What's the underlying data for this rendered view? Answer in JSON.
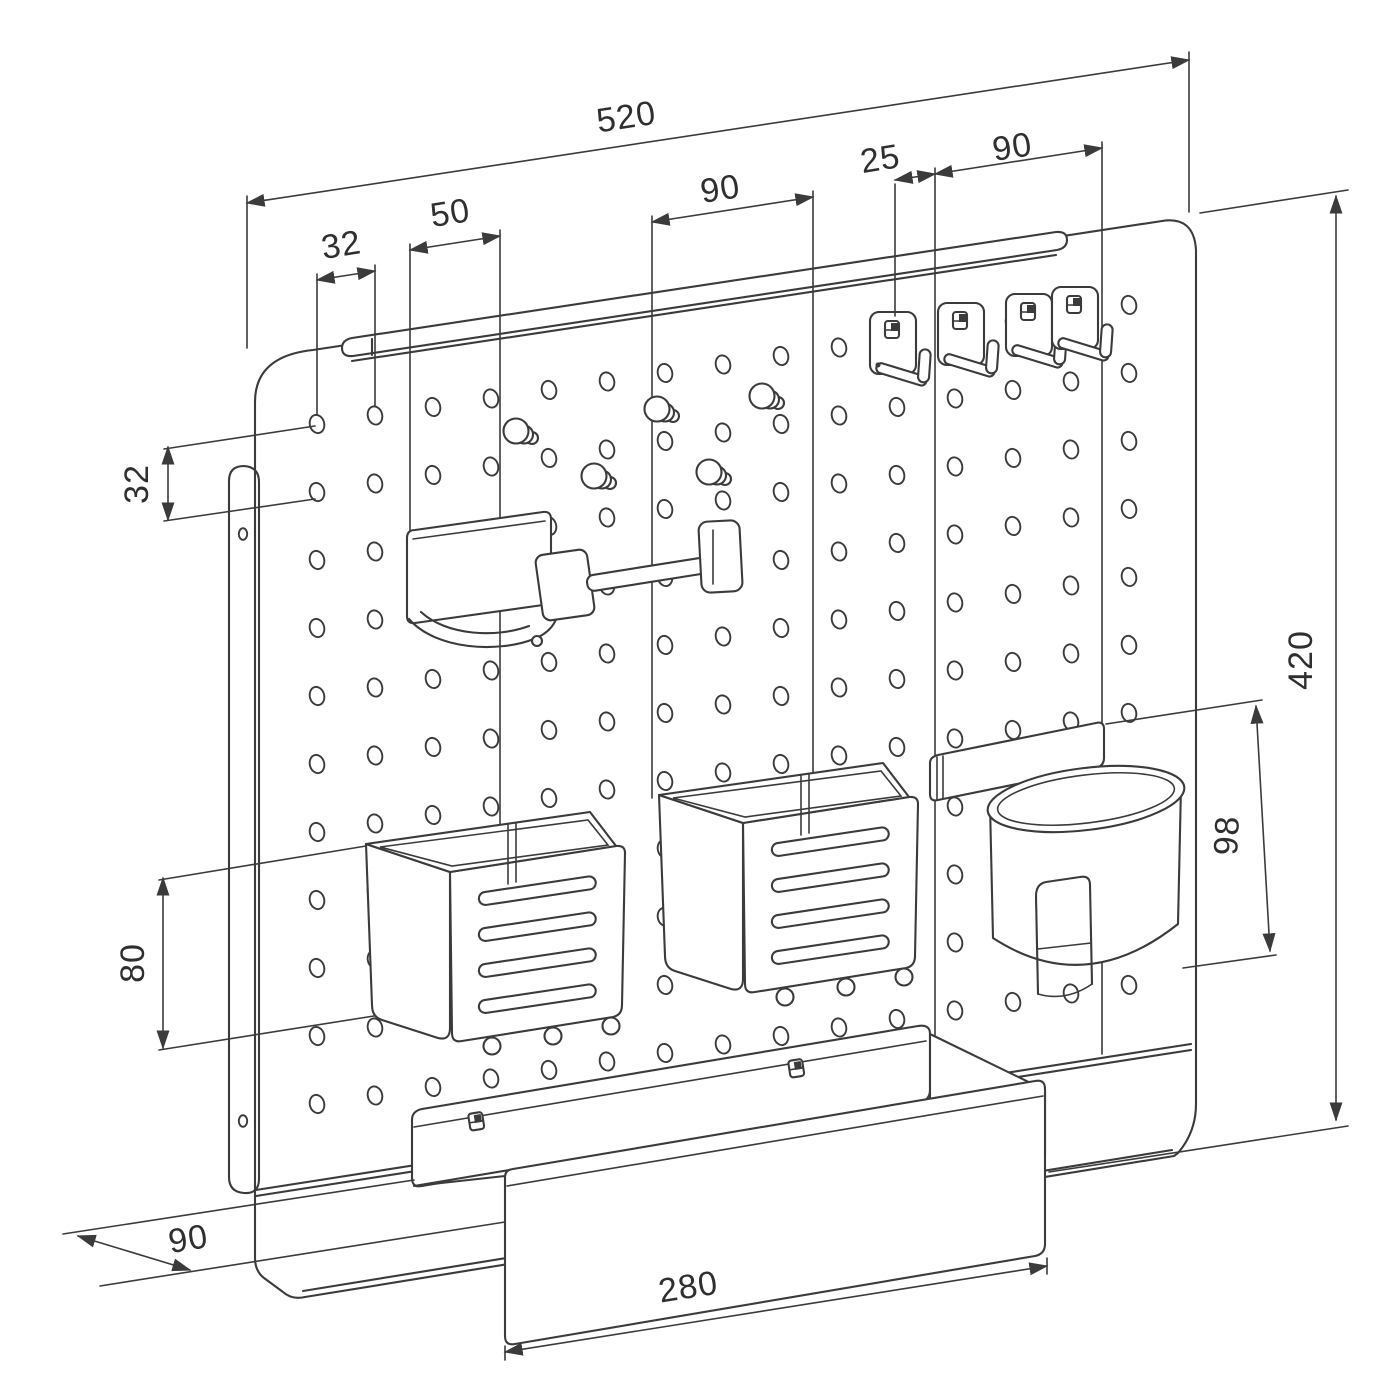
{
  "meta": {
    "type": "technical-drawing",
    "subject": "pegboard wall organizer with accessories",
    "units_implied": "mm"
  },
  "colors": {
    "background": "#ffffff",
    "line": "#3b3b3b",
    "text": "#2f2f2f"
  },
  "dimensions": {
    "overall_width": "520",
    "overall_height": "420",
    "hook_group_width": "90",
    "hook_offset": "25",
    "accessory_spacing": "90",
    "hook_bracket_width": "50",
    "hole_pitch_horizontal": "32",
    "hole_pitch_vertical": "32",
    "basket_height": "80",
    "cup_holder_height": "98",
    "shelf_depth": "90",
    "shelf_width": "280"
  },
  "components": [
    "pegboard-panel",
    "wall-mount-bracket",
    "hanging-rail",
    "single-hooks-x4",
    "pegs-x5",
    "headphone-hook",
    "slotted-basket-x2",
    "cup-holder",
    "bottom-shelf"
  ]
}
